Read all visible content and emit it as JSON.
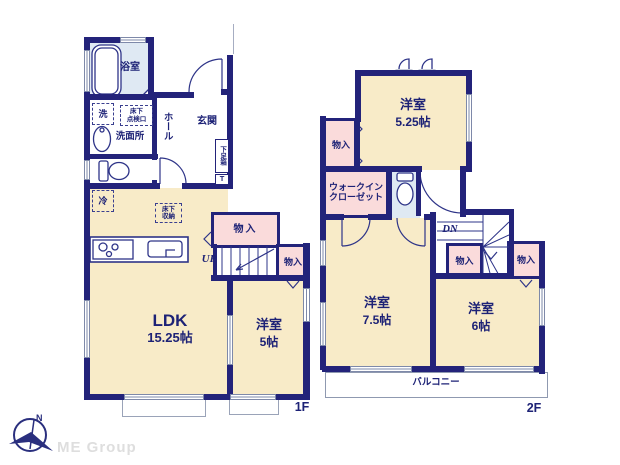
{
  "floor1": {
    "floor_label": "1F",
    "bath": "浴室",
    "washer": "洗",
    "underfloor_hatch_l1": "床下",
    "underfloor_hatch_l2": "点検口",
    "washroom": "洗面所",
    "hall": "ホール",
    "entrance": "玄関",
    "shoe_box": "下足箱",
    "shoe_box_t": "T",
    "fridge": "冷",
    "underfloor_storage_l1": "床下",
    "underfloor_storage_l2": "収納",
    "closet_a": "物入",
    "closet_b": "物入",
    "stairs_up": "UP",
    "ldk_name": "LDK",
    "ldk_size": "15.25帖",
    "bedroom_name": "洋室",
    "bedroom_size": "5帖"
  },
  "floor2": {
    "floor_label": "2F",
    "bedroom1_name": "洋室",
    "bedroom1_size": "5.25帖",
    "closet_a": "物入",
    "wic_l1": "ウォークイン",
    "wic_l2": "クローゼット",
    "stairs_down": "DN",
    "closet_b": "物入",
    "closet_c": "物入",
    "bedroom2_name": "洋室",
    "bedroom2_size": "7.5帖",
    "bedroom3_name": "洋室",
    "bedroom3_size": "6帖",
    "balcony": "バルコニー"
  },
  "footer": {
    "logo": "ME Group",
    "compass_north": "N"
  },
  "colors": {
    "wall": "#23237a",
    "room_fill": "#f8ebc8",
    "wet_area_fill": "#dfe9f3",
    "closet_fill": "#fadbdb",
    "label_text": "#1d2276",
    "logo_text": "#dedede"
  }
}
